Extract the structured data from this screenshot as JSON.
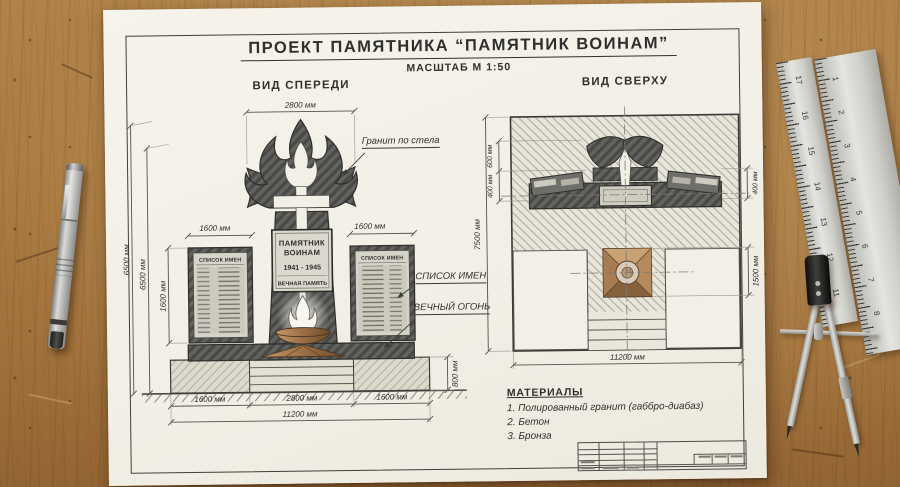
{
  "colors": {
    "wood": "#a87c44",
    "paper": "#f2efe6",
    "ink": "#3c3c3a",
    "granite_dark": "#5a5a57",
    "bronze": "#a87850"
  },
  "sheet": {
    "title": "ПРОЕКТ ПАМЯТНИКА “ПАМЯТНИК ВОИНАМ”",
    "scale": "МАСШТАБ М 1:50"
  },
  "front": {
    "heading": "ВИД СПЕРЕДИ",
    "plaque": {
      "l1": "ПАМЯТНИК",
      "l2": "ВОИНАМ",
      "years": "1941 - 1945",
      "l3": "ВЕЧНАЯ ПАМЯТЬ"
    },
    "panel_header": "СПИСОК ИМЕН",
    "callouts": {
      "granite": "Гранит по стела",
      "names": "СПИСОК ИМЕН",
      "flame": "ВЕЧНЫЙ ОГОНЬ"
    },
    "dims": {
      "top_2800": "2800 мм",
      "h_outer": "6500 мм",
      "h_inner": "6500 мм",
      "panel_w_left": "1600 мм",
      "panel_w_right": "1600 мм",
      "panel_h": "1600 мм",
      "base_h": "800 мм",
      "b_left": "1600 мм",
      "b_center": "2800 мм",
      "b_right": "1600 мм",
      "b_total": "11200 мм"
    }
  },
  "top": {
    "heading": "ВИД СВЕРХУ",
    "dims": {
      "h_total": "7500 мм",
      "d600": "600 мм",
      "d400l": "400 мм",
      "d400r": "400 мм",
      "d1500": "1500 мм",
      "b_total": "11200 мм"
    }
  },
  "materials": {
    "heading": "МАТЕРИАЛЫ",
    "items": [
      "1. Полированный гранит (габбро-диабаз)",
      "2. Бетон",
      "3. Бронза"
    ]
  },
  "rulers": {
    "a": [
      "17",
      "16",
      "15",
      "14",
      "13",
      "12",
      "11"
    ],
    "b": [
      "1",
      "2",
      "3",
      "4",
      "5",
      "6",
      "7",
      "8"
    ]
  }
}
